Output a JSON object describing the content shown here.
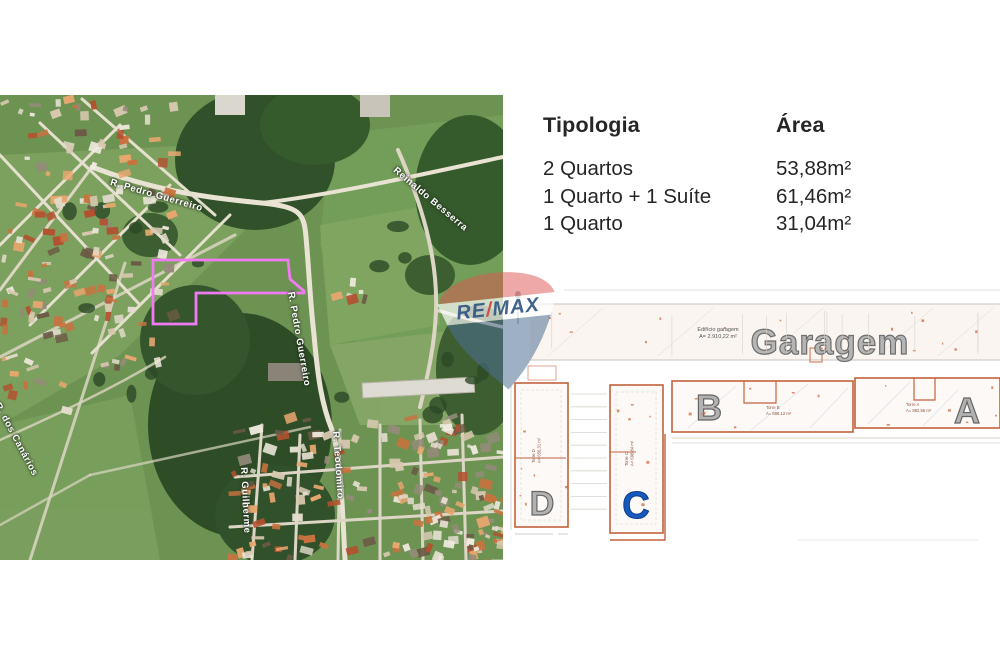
{
  "typology_table": {
    "header": {
      "tipologia": "Tipologia",
      "area": "Área"
    },
    "rows": [
      {
        "tipologia": "2 Quartos",
        "area": "53,88m²"
      },
      {
        "tipologia": "1 Quarto + 1 Suíte",
        "area": "61,46m²"
      },
      {
        "tipologia": "1 Quarto",
        "area": "31,04m²"
      }
    ]
  },
  "map": {
    "street_labels": [
      {
        "text": "R. Pedro Guerreiro"
      },
      {
        "text": "Reinaldo Besserra"
      },
      {
        "text": "R. Pedro Guerreiro"
      },
      {
        "text": "R. dos Canários"
      },
      {
        "text": "R. Teodomiro"
      },
      {
        "text": "R. Guilherme"
      }
    ],
    "plot_outline_color": "#ef7bf2"
  },
  "brand": {
    "re": "RE",
    "slash": "/",
    "max": "MAX"
  },
  "site_plan": {
    "garage_title": "Garagem",
    "garage_note": [
      "Edifício garagem",
      "A= 2.910,22 m²"
    ],
    "towers": {
      "a": {
        "letter": "A",
        "note": [
          "Torre A",
          "A= 982,56 m²"
        ]
      },
      "b": {
        "letter": "B",
        "note": [
          "Torre B",
          "A= 698,12 m²"
        ]
      },
      "c": {
        "letter": "C",
        "note": [
          "Torre C",
          "A= 698,84 m²"
        ]
      },
      "d": {
        "letter": "D",
        "note": [
          "Torre D",
          "A= 656,31 m²"
        ]
      }
    },
    "outline_color": "#c2613c",
    "tower_letter_gray": "#b2b2b2",
    "tower_letter_blue": "#1659bc"
  }
}
